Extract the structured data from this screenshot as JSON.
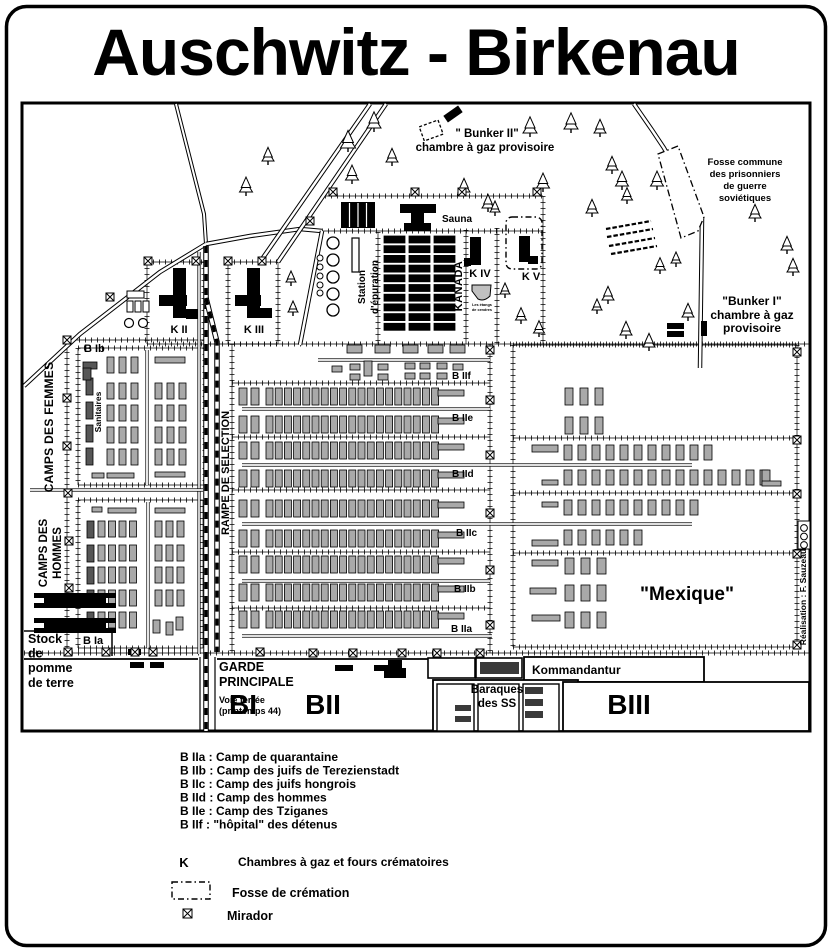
{
  "title": "Auschwitz - Birkenau",
  "map": {
    "bunker2": {
      "line1": "\" Bunker II\"",
      "line2": "chambre à gaz provisoire"
    },
    "fosse_commune": {
      "line1": "Fosse commune",
      "line2": "des prisonniers",
      "line3": "de guerre",
      "line4": "soviétiques"
    },
    "bunker1": {
      "line1": "\"Bunker I\"",
      "line2": "chambre à gaz",
      "line3": "provisoire"
    },
    "sauna": "Sauna",
    "station": {
      "line1": "Station",
      "line2": "d'épuration"
    },
    "kanada": "KANADA",
    "k2": "K II",
    "k3": "K III",
    "k4": "K IV",
    "k5": "K V",
    "ash_ponds": {
      "line1": "Les étangs",
      "line2": "de cendres"
    },
    "camps_femmes": "CAMPS DES FEMMES",
    "camps_hommes": {
      "line1": "CAMPS DES",
      "line2": "HOMMES"
    },
    "b1b": "B Ib",
    "b1a": "B Ia",
    "sanitaires": "Sanitaires",
    "rampe": "RAMPE DE SELECTION",
    "b2a": "B IIa",
    "b2b": "B IIb",
    "b2c": "B IIc",
    "b2d": "B IId",
    "b2e": "B IIe",
    "b2f": "B IIf",
    "mexique": "\"Mexique\"",
    "stock": {
      "line1": "Stock",
      "line2": "de",
      "line3": "pomme",
      "line4": "de terre"
    },
    "garde": {
      "line1": "GARDE",
      "line2": "PRINCIPALE"
    },
    "voie": {
      "line1": "Voie ferrée",
      "line2": "(printemps 44)"
    },
    "bi": "BI",
    "bii": "BII",
    "biii": "BIII",
    "kommandantur": "Kommandantur",
    "baraques_ss": {
      "line1": "Baraques",
      "line2": "des SS"
    },
    "credit": "Réalisation : F. Sauzeau"
  },
  "legend": {
    "items": [
      "B IIa : Camp de quarantaine",
      "B IIb : Camp des juifs de Terezienstadt",
      "B IIc : Camp des juifs hongrois",
      "B IId : Camp des hommes",
      "B IIe : Camp des Tziganes",
      "B IIf : \"hôpital\" des détenus"
    ],
    "k_symbol": "K",
    "k_label": "Chambres à gaz et fours crématoires",
    "fosse_label": "Fosse de crémation",
    "mirador_label": "Mirador"
  },
  "colors": {
    "ink": "#000000",
    "paper": "#ffffff",
    "barrack": "#a9a9a9",
    "dark": "#3a3a3a"
  }
}
